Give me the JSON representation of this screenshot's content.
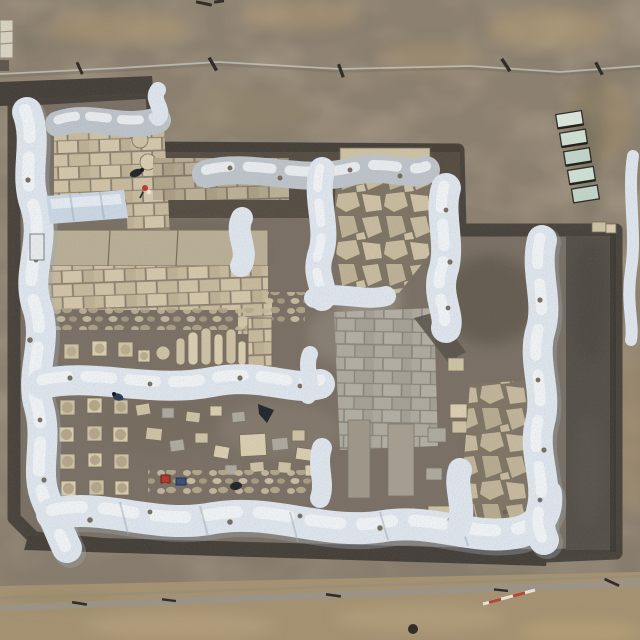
{
  "meta": {
    "type": "aerial-photograph",
    "subject": "Top-down drone photograph of an archaeological excavation: rectangular trench grid with earthen balks wrapped in white plastic sheeting, ashlar stone walls, paved floors, column bases and drums, surrounded by bare brown earth with a dirt road along the bottom",
    "dimensions": "640x640"
  },
  "palette": {
    "dirt_base": "#8c8070",
    "dirt_tan": "#ab9670",
    "dirt_dark": "#6f675a",
    "cut_dark": "#46403a",
    "exc_soil": "#7a7065",
    "exc_band": "#564e44",
    "exc_soil_dark": "#635b50",
    "trench_dark": "#55504a",
    "trench_edge": "#3b3731",
    "tarp_white": "#dde4ec",
    "tarp_highlight": "#f2f5f8",
    "tarp_shade": "#9fabb8",
    "tarp_gray": "#bcc3c9",
    "tarp_blue": "#c9d6e3",
    "stone_tan": "#cdc1a5",
    "stone_tan_light": "#d8ccb1",
    "stone_edge": "#776d5b",
    "stone_gap": "#8b8170",
    "flag_gray": "#aea99f",
    "flag_gap": "#8a857b",
    "rubble": "#bfb398",
    "road_tan": "#a59272",
    "road_tan_light": "#b7a47e",
    "road_line": "#98968e",
    "panel_green": "#cfdfd3",
    "panel_green_alt": "#c2d4c8",
    "panel_frame": "#2c2c27",
    "stake_dark": "#2f2b26",
    "string_line": "#cfcec6",
    "worker_red": "#bf3a2e",
    "worker_blue": "#2c3a5c",
    "worker_dark": "#23262b",
    "crate_red": "#b03a2e",
    "crate_blue": "#3a4f78",
    "pole_red": "#b44338"
  },
  "scene": {
    "features": [
      {
        "name": "surface-soil",
        "desc": "mottled grey-brown earth with tan patches surrounding the dig",
        "region": [
          0,
          0,
          640,
          640
        ]
      },
      {
        "name": "survey-string-line",
        "desc": "light string line with dark wooden stakes crossing the top",
        "region": [
          0,
          58,
          640,
          24
        ]
      },
      {
        "name": "excavation-pit",
        "desc": "large irregular excavated area with dark cut edges",
        "region": [
          10,
          85,
          610,
          475
        ]
      },
      {
        "name": "tarp-balk-west",
        "desc": "long wavy white-plastic-wrapped balk, west side",
        "region": [
          8,
          100,
          45,
          450
        ]
      },
      {
        "name": "tarp-balk-northwest",
        "desc": "grey tarp over north wall of NW room",
        "region": [
          52,
          108,
          110,
          30
        ]
      },
      {
        "name": "tarp-balk-north-central",
        "desc": "grey tarp band over central north wall",
        "region": [
          200,
          155,
          230,
          45
        ]
      },
      {
        "name": "tarp-balk-northeast-vertical",
        "desc": "white tarp balk running south from north edge",
        "region": [
          428,
          172,
          42,
          160
        ]
      },
      {
        "name": "tarp-balk-mid-horizontal",
        "desc": "white tarp balk dividing site east-west",
        "region": [
          30,
          362,
          295,
          40
        ]
      },
      {
        "name": "tarp-balk-south",
        "desc": "long white tarp balk along the south side",
        "region": [
          36,
          492,
          515,
          60
        ]
      },
      {
        "name": "tarp-balk-east-vertical",
        "desc": "white tarp balk along east side of main area",
        "region": [
          524,
          228,
          45,
          320
        ]
      },
      {
        "name": "tarp-covered-feature",
        "desc": "small rectangular feature under blue-white sheet in NW room",
        "region": [
          45,
          190,
          85,
          34
        ]
      },
      {
        "name": "ashlar-pavement-northwest",
        "desc": "tan squared stone-block pavement in NW room",
        "region": [
          54,
          130,
          112,
          108
        ]
      },
      {
        "name": "ashlar-wall-north",
        "desc": "long cut-stone wall course in dark north strip",
        "region": [
          153,
          156,
          135,
          44
        ]
      },
      {
        "name": "ashlar-wall-platform",
        "desc": "wide platform of squared tan masonry courses",
        "region": [
          48,
          226,
          222,
          104
        ]
      },
      {
        "name": "crazy-paving-north",
        "desc": "irregular flagstone floor, upper centre",
        "region": [
          336,
          148,
          98,
          148
        ]
      },
      {
        "name": "colonnade-row",
        "desc": "row of square column bases and standing column drums",
        "region": [
          60,
          318,
          215,
          50
        ]
      },
      {
        "name": "column-base-grid",
        "desc": "grid of 12 square column bases (4 rows x 3 cols) in SW hall",
        "region": [
          55,
          395,
          80,
          105
        ]
      },
      {
        "name": "stone-scatter-south",
        "desc": "scattered worked blocks and finds laid out on SW hall floor",
        "region": [
          130,
          398,
          200,
          100
        ]
      },
      {
        "name": "flagstone-pavement-south",
        "desc": "large light-grey paved floor, south centre",
        "region": [
          332,
          306,
          108,
          142
        ]
      },
      {
        "name": "crazy-paving-southeast",
        "desc": "irregular stone paving near SE corner",
        "region": [
          464,
          378,
          76,
          152
        ]
      },
      {
        "name": "deep-trench-east",
        "desc": "deep dark sounding trench along the east side",
        "region": [
          566,
          232,
          50,
          320
        ]
      },
      {
        "name": "panel-stack",
        "desc": "five pale-green panels stacked on the surface east of the dig",
        "region": [
          558,
          112,
          36,
          100
        ]
      },
      {
        "name": "dirt-road",
        "desc": "lighter tan dirt road with grader line across the bottom",
        "region": [
          0,
          572,
          640,
          68
        ]
      },
      {
        "name": "range-pole",
        "desc": "red-and-white survey pole lying on the road",
        "region": [
          480,
          588,
          58,
          20
        ]
      },
      {
        "name": "stone-block-edge",
        "desc": "light stone block at the far left edge",
        "region": [
          0,
          20,
          14,
          40
        ]
      }
    ],
    "people": [
      {
        "name": "worker-dark-north",
        "desc": "crouching figure in dark clothing",
        "at": [
          136,
          172
        ]
      },
      {
        "name": "worker-red-north",
        "desc": "figure in red and white",
        "at": [
          146,
          189
        ]
      },
      {
        "name": "worker-blue-southwest",
        "desc": "figure in dark blue jacket",
        "at": [
          118,
          396
        ]
      },
      {
        "name": "worker-dark-south",
        "desc": "crouching dark figure among finds",
        "at": [
          236,
          486
        ]
      }
    ],
    "objects": [
      {
        "name": "crate-red",
        "at": [
          165,
          478
        ]
      },
      {
        "name": "crate-blue",
        "at": [
          180,
          481
        ]
      },
      {
        "name": "equipment-dark",
        "desc": "dark folded object / wheelbarrow",
        "at": [
          263,
          412
        ]
      },
      {
        "name": "column-drums-standing",
        "count": 6
      },
      {
        "name": "column-bases-north-row",
        "count": 4
      },
      {
        "name": "glass-panels",
        "count": 5
      }
    ]
  }
}
